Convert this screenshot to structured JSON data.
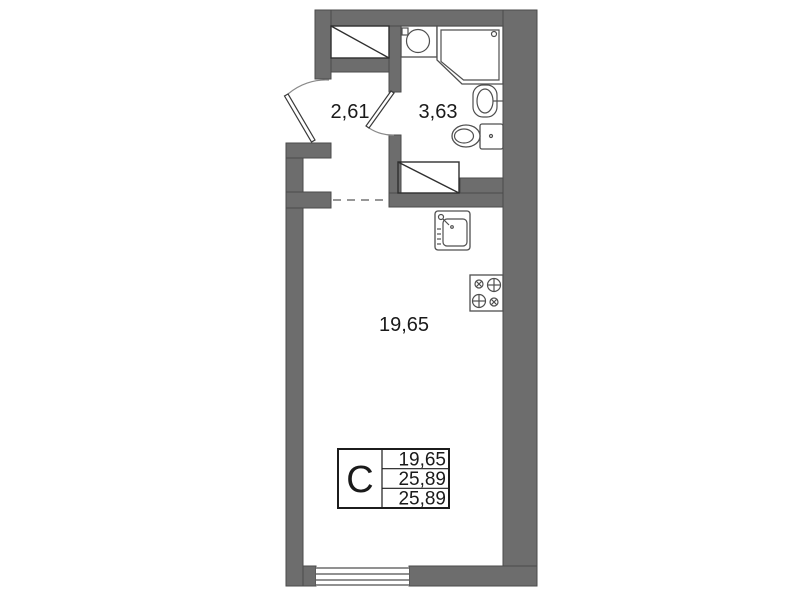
{
  "rooms": {
    "hall": {
      "area": "2,61"
    },
    "bathroom": {
      "area": "3,63"
    },
    "living": {
      "area": "19,65"
    }
  },
  "legend": {
    "type": "С",
    "rows": [
      "19,65",
      "25,89",
      "25,89"
    ]
  },
  "colors": {
    "wall": "#6d6d6d",
    "wall_edge": "#4a4a4a",
    "fixture_line": "#4f4f4f",
    "text": "#1a1a1a",
    "background": "#ffffff"
  },
  "icons": {
    "wardrobe": "rect-with-diagonal",
    "shower": "chamfered-square-cabin",
    "washbasin": "counter-with-round-bowl",
    "vanity_sink": "oval-basin",
    "toilet": "bowl-with-cistern",
    "appliance_spot": "rect-with-diagonal",
    "kitchen_sink": "square-sink-with-tap",
    "stove": "four-burner-hob",
    "entrance_door": "door-swing-arc",
    "bathroom_door": "door-swing-arc",
    "window": "multi-line-window",
    "room_boundary": "dashed-line"
  }
}
